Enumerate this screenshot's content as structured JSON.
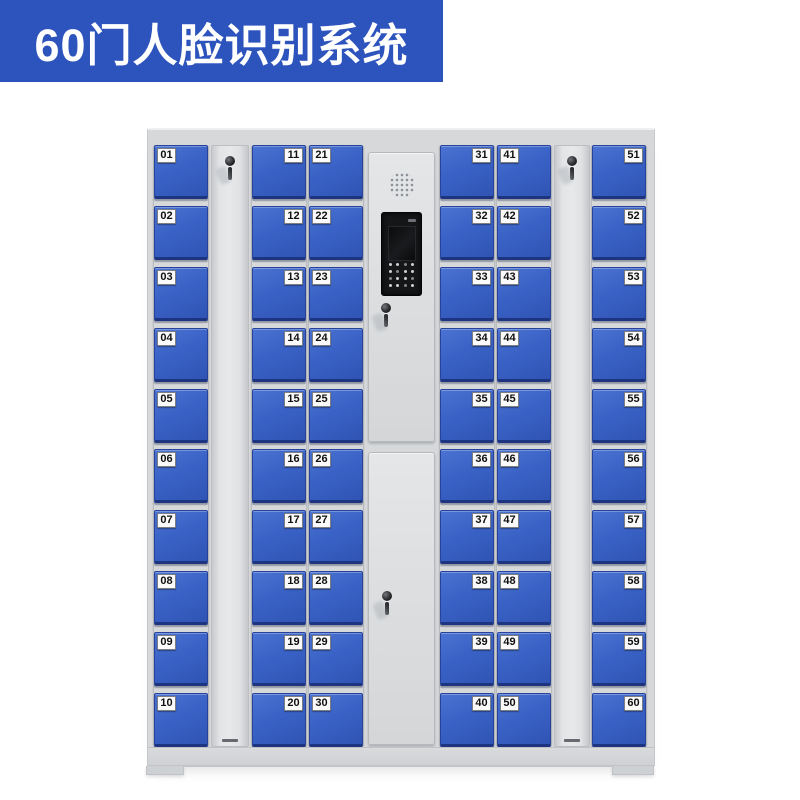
{
  "banner": {
    "title": "60门人脸识别系统",
    "bg_color": "#2d53bd",
    "text_color": "#ffffff"
  },
  "cabinet": {
    "frame_color": "#d6d8da",
    "door_colors": {
      "light": "#4a73d2",
      "base": "#3a62c6",
      "deep": "#2f54b4",
      "edge": "#1d3480"
    },
    "plate": {
      "bg": "#fafafa",
      "text_color": "#111111"
    },
    "layout_order": [
      "column-1",
      "lock-strip-1",
      "column-2",
      "column-3",
      "control-panel",
      "column-4",
      "column-5",
      "lock-strip-2",
      "column-6"
    ],
    "columns": [
      {
        "name": "column-1",
        "label_side": "left",
        "doors": [
          "01",
          "02",
          "03",
          "04",
          "05",
          "06",
          "07",
          "08",
          "09",
          "10"
        ]
      },
      {
        "name": "column-2",
        "label_side": "right",
        "doors": [
          "11",
          "12",
          "13",
          "14",
          "15",
          "16",
          "17",
          "18",
          "19",
          "20"
        ]
      },
      {
        "name": "column-3",
        "label_side": "left",
        "doors": [
          "21",
          "22",
          "23",
          "24",
          "25",
          "26",
          "27",
          "28",
          "29",
          "30"
        ]
      },
      {
        "name": "column-4",
        "label_side": "right",
        "doors": [
          "31",
          "32",
          "33",
          "34",
          "35",
          "36",
          "37",
          "38",
          "39",
          "40"
        ]
      },
      {
        "name": "column-5",
        "label_side": "left",
        "doors": [
          "41",
          "42",
          "43",
          "44",
          "45",
          "46",
          "47",
          "48",
          "49",
          "50"
        ]
      },
      {
        "name": "column-6",
        "label_side": "right",
        "doors": [
          "51",
          "52",
          "53",
          "54",
          "55",
          "56",
          "57",
          "58",
          "59",
          "60"
        ]
      }
    ],
    "lock_strips": [
      {
        "name": "lock-strip-1",
        "icon": "keyhole-with-keys"
      },
      {
        "name": "lock-strip-2",
        "icon": "keyhole-with-keys"
      }
    ],
    "control_panel": {
      "speaker_icon": "speaker-grill",
      "terminal_icon": "face-recognition-terminal",
      "camera_icon": "camera-window",
      "keypad_icon": "keypad-grid",
      "upper_lock_icon": "keyhole-with-keys",
      "lower_lock_icon": "keyhole-with-keys"
    }
  }
}
